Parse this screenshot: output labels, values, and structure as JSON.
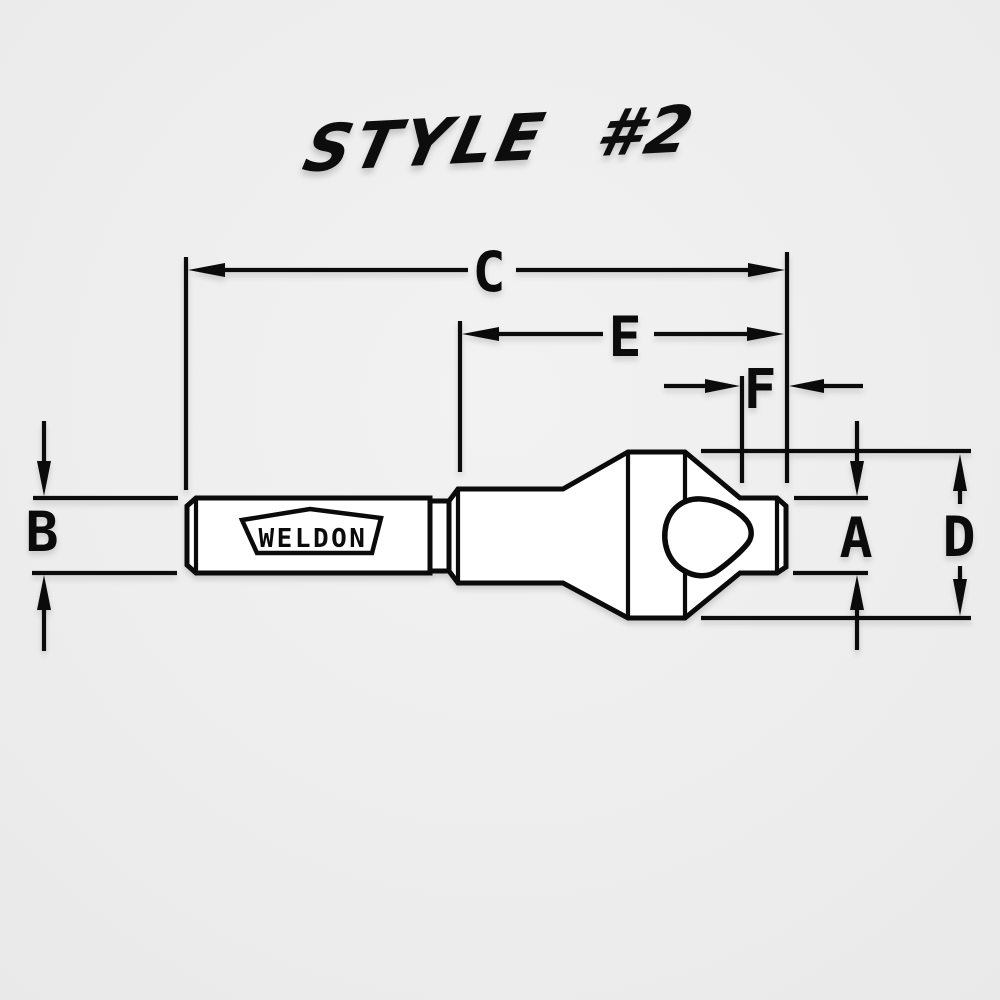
{
  "title": "STYLE #2",
  "colors": {
    "background": "#ededed",
    "line": "#0b0b0b",
    "fill": "#ffffff"
  },
  "drawing": {
    "brand_label": "WELDON",
    "dimension_labels": {
      "overall_length": "C",
      "body_length": "E",
      "pilot_length": "F",
      "shank_diameter": "B",
      "pilot_diameter": "A",
      "head_diameter": "D"
    }
  }
}
